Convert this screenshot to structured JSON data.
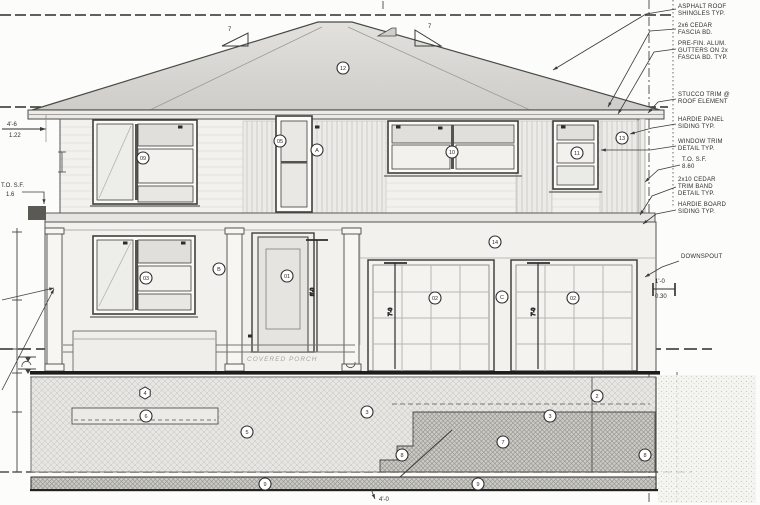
{
  "meta": {
    "sheet_type": "house front elevation drawing"
  },
  "colors": {
    "paper": "#fcfcfa",
    "line": "#3a3a3a",
    "heavy_line": "#1d1d1d",
    "roof_fill": "#d9d8d4",
    "wall_fill": "#f2f1ee",
    "pane_shaded": "#e0dfdb",
    "hatch_light": "#c6c5c1",
    "hatch_dark": "#8f8e8a"
  },
  "labels": {
    "porch": "COVERED PORCH",
    "bottom_dim": "4'-0",
    "roof_slope_left": "7",
    "roof_slope_right": "7",
    "dim_overhang_ft": "4'-6",
    "dim_overhang_m": "1.22",
    "dim_right_ft": "1'-0",
    "dim_right_m": "0.30",
    "left_note_l1": "T.O. S.F.",
    "left_note_l2": "1.6",
    "garage_door_dim": "7'-0",
    "entry_door_dim": "8'-0"
  },
  "notes": [
    {
      "x": 678,
      "y": 8,
      "lines": [
        "ASPHALT ROOF",
        "SHINGLES TYP."
      ],
      "leader": [
        [
          676,
          9
        ],
        [
          646,
          14
        ],
        [
          553,
          70
        ]
      ]
    },
    {
      "x": 678,
      "y": 27,
      "lines": [
        "2x6 CEDAR",
        "FASCIA BD."
      ],
      "leader": [
        [
          676,
          29
        ],
        [
          650,
          31
        ],
        [
          608,
          107
        ]
      ]
    },
    {
      "x": 678,
      "y": 45,
      "lines": [
        "PRE-FIN. ALUM.",
        "GUTTERS ON 2x",
        "FASCIA BD. TYP."
      ],
      "leader": [
        [
          676,
          49
        ],
        [
          654,
          52
        ],
        [
          618,
          114
        ]
      ]
    },
    {
      "x": 678,
      "y": 96,
      "lines": [
        "STUCCO TRIM @",
        "ROOF ELEMENT"
      ],
      "leader": [
        [
          676,
          99
        ],
        [
          658,
          102
        ],
        [
          648,
          113
        ]
      ]
    },
    {
      "x": 678,
      "y": 121,
      "lines": [
        "HARDIE PANEL",
        "SIDING TYP."
      ],
      "leader": [
        [
          676,
          124
        ],
        [
          652,
          128
        ],
        [
          630,
          134
        ]
      ]
    },
    {
      "x": 678,
      "y": 143,
      "lines": [
        "WINDOW TRIM",
        "DETAIL TYP."
      ],
      "leader": [
        [
          676,
          146
        ],
        [
          650,
          150
        ],
        [
          601,
          150
        ]
      ]
    },
    {
      "x": 682,
      "y": 161,
      "lines": [
        "T.O. S.F.",
        "8.60"
      ],
      "leader": [
        [
          680,
          165
        ],
        [
          658,
          170
        ],
        [
          645,
          182
        ]
      ]
    },
    {
      "x": 678,
      "y": 181,
      "lines": [
        "2x10 CEDAR",
        "TRIM BAND",
        "DETAIL TYP."
      ],
      "leader": [
        [
          676,
          187
        ],
        [
          652,
          196
        ],
        [
          640,
          215
        ]
      ]
    },
    {
      "x": 678,
      "y": 206,
      "lines": [
        "HARDIE BOARD",
        "SIDING TYP."
      ],
      "leader": [
        [
          676,
          210
        ],
        [
          656,
          214
        ],
        [
          643,
          224
        ]
      ]
    },
    {
      "x": 681,
      "y": 258,
      "lines": [
        "DOWNSPOUT"
      ],
      "leader": [
        [
          679,
          261
        ],
        [
          662,
          267
        ],
        [
          645,
          277
        ]
      ]
    }
  ],
  "callouts": [
    {
      "label": "12",
      "x": 343,
      "y": 68,
      "shape": "circle"
    },
    {
      "label": "09",
      "x": 143,
      "y": 158,
      "shape": "circle"
    },
    {
      "label": "05",
      "x": 280,
      "y": 141,
      "shape": "circle"
    },
    {
      "label": "A",
      "x": 317,
      "y": 150,
      "shape": "circle"
    },
    {
      "label": "10",
      "x": 452,
      "y": 152,
      "shape": "circle"
    },
    {
      "label": "11",
      "x": 577,
      "y": 153,
      "shape": "circle"
    },
    {
      "label": "13",
      "x": 622,
      "y": 138,
      "shape": "circle"
    },
    {
      "label": "03",
      "x": 146,
      "y": 278,
      "shape": "circle"
    },
    {
      "label": "B",
      "x": 219,
      "y": 269,
      "shape": "circle"
    },
    {
      "label": "01",
      "x": 287,
      "y": 276,
      "shape": "circle"
    },
    {
      "label": "14",
      "x": 495,
      "y": 242,
      "shape": "circle"
    },
    {
      "label": "C",
      "x": 502,
      "y": 297,
      "shape": "circle"
    },
    {
      "label": "02",
      "x": 435,
      "y": 298,
      "shape": "circle"
    },
    {
      "label": "02",
      "x": 573,
      "y": 298,
      "shape": "circle"
    },
    {
      "label": "4",
      "x": 145,
      "y": 393,
      "shape": "hex"
    },
    {
      "label": "6",
      "x": 146,
      "y": 416,
      "shape": "circle"
    },
    {
      "label": "5",
      "x": 247,
      "y": 432,
      "shape": "circle"
    },
    {
      "label": "3",
      "x": 367,
      "y": 412,
      "shape": "circle"
    },
    {
      "label": "3",
      "x": 550,
      "y": 416,
      "shape": "circle"
    },
    {
      "label": "7",
      "x": 503,
      "y": 442,
      "shape": "circle"
    },
    {
      "label": "8",
      "x": 402,
      "y": 455,
      "shape": "circle"
    },
    {
      "label": "8",
      "x": 645,
      "y": 455,
      "shape": "circle"
    },
    {
      "label": "9",
      "x": 265,
      "y": 484,
      "shape": "circle"
    },
    {
      "label": "9",
      "x": 478,
      "y": 484,
      "shape": "circle"
    },
    {
      "label": "2",
      "x": 597,
      "y": 396,
      "shape": "circle"
    }
  ],
  "tags": [
    {
      "x": 180,
      "y": 127
    },
    {
      "x": 317,
      "y": 127
    },
    {
      "x": 398,
      "y": 127
    },
    {
      "x": 440,
      "y": 128
    },
    {
      "x": 563,
      "y": 127
    },
    {
      "x": 125,
      "y": 243
    },
    {
      "x": 183,
      "y": 243
    },
    {
      "x": 250,
      "y": 336
    }
  ]
}
